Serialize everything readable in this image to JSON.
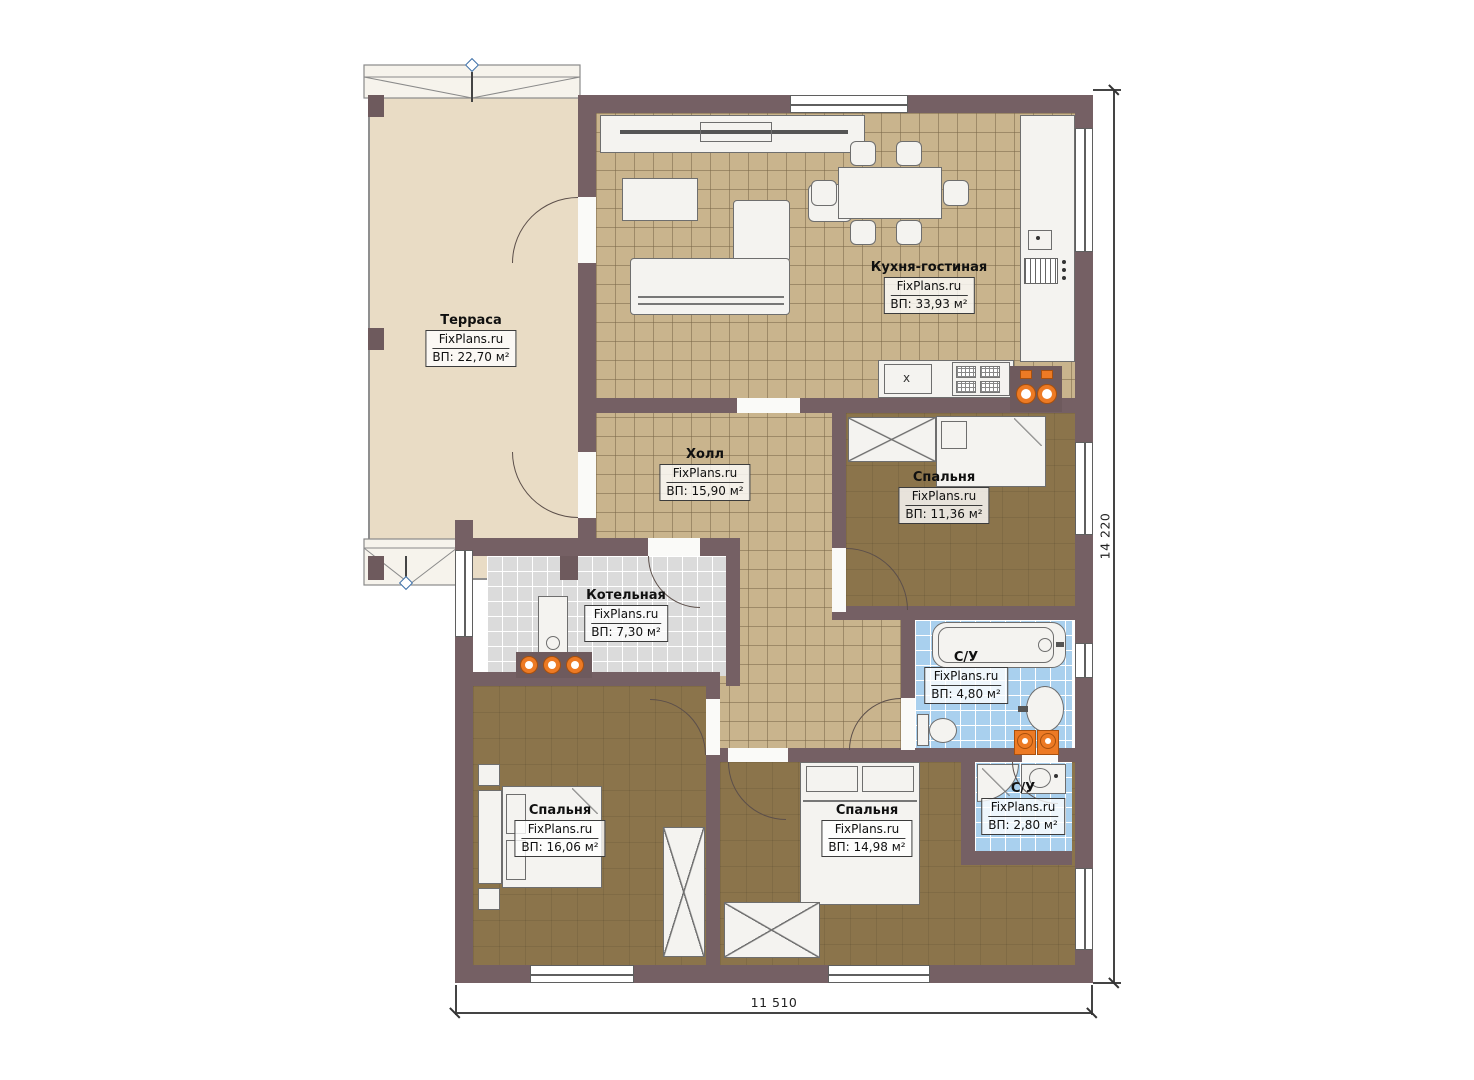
{
  "rooms": [
    {
      "name": "Терраса",
      "brand": "FixPlans.ru",
      "area": "ВП: 22,70 м²"
    },
    {
      "name": "Кухня-гостиная",
      "brand": "FixPlans.ru",
      "area": "ВП: 33,93 м²"
    },
    {
      "name": "Холл",
      "brand": "FixPlans.ru",
      "area": "ВП: 15,90 м²"
    },
    {
      "name": "Спальня",
      "brand": "FixPlans.ru",
      "area": "ВП: 11,36 м²"
    },
    {
      "name": "Котельная",
      "brand": "FixPlans.ru",
      "area": "ВП: 7,30 м²"
    },
    {
      "name": "С/У",
      "brand": "FixPlans.ru",
      "area": "ВП: 4,80 м²"
    },
    {
      "name": "Спальня",
      "brand": "FixPlans.ru",
      "area": "ВП: 16,06 м²"
    },
    {
      "name": "Спальня",
      "brand": "FixPlans.ru",
      "area": "ВП: 14,98 м²"
    },
    {
      "name": "С/У",
      "brand": "FixPlans.ru",
      "area": "ВП: 2,80 м²"
    }
  ],
  "dimensions": {
    "bottom": "11 510",
    "right": "14 220"
  },
  "glyphs": {
    "cabinet_x": "x"
  },
  "colors": {
    "wall": "#756064",
    "tan_tile": "#c9b48d",
    "wood": "#8b744b",
    "gray_tile": "#dbdbdb",
    "blue_tile": "#a9d0ee",
    "orange_fixture": "#ed7a24",
    "marker_blue": "#3c6fa8",
    "terrace": "#e9dcc5"
  }
}
